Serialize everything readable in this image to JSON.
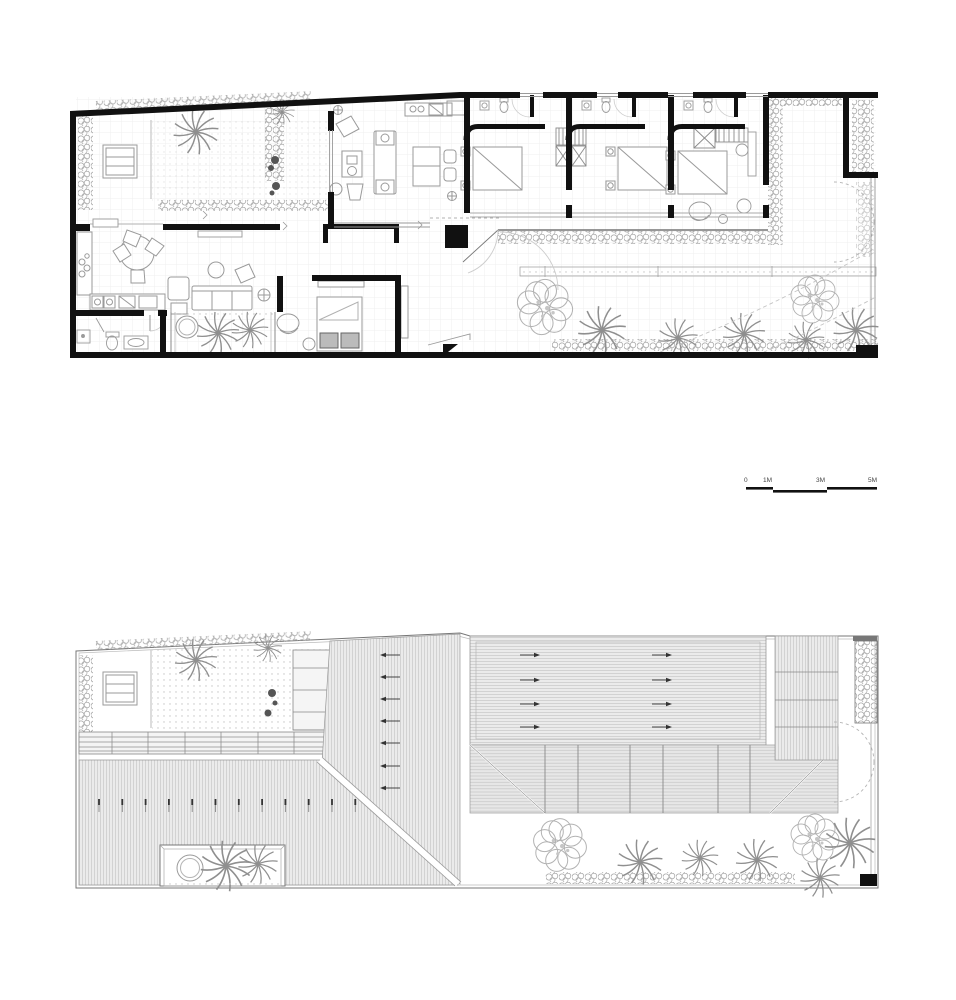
{
  "drawing": {
    "kind": "architectural plan sheet",
    "plans": {
      "top": "floor-plan",
      "bottom": "roof-plan"
    }
  },
  "scale_bar": {
    "labels": [
      "0",
      "1M",
      "3M",
      "5M"
    ]
  },
  "colors": {
    "background": "#ffffff",
    "wall": "#111111",
    "thin_line": "#8a8a8a",
    "furniture": "#9a9a9a",
    "vegetation": "#a0a0a0",
    "roof_fill": "#ebebeb",
    "roof_hatch": "#d2d2d2",
    "text": "#444444"
  }
}
